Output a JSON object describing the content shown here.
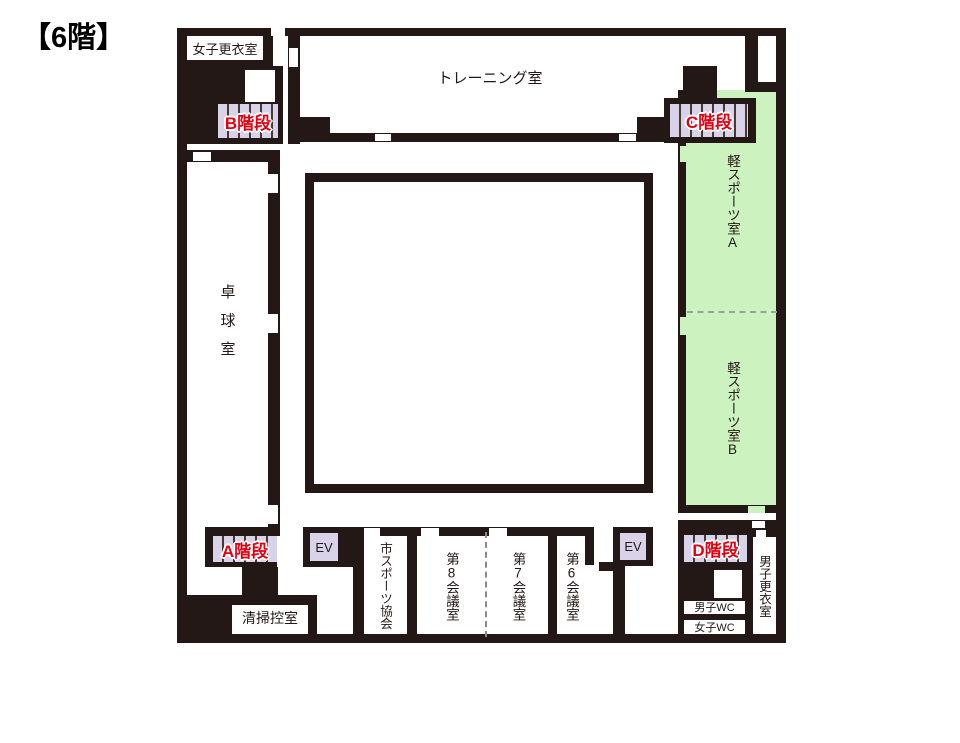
{
  "title": "【6階】",
  "colors": {
    "wall": "#231815",
    "stair_fill": "#d9d3ea",
    "green_room": "#ccf3bf",
    "stair_text_red": "#e60012",
    "background": "#ffffff"
  },
  "rooms": {
    "women_changing": "女子更衣室",
    "women_wc_top": "女子WC",
    "men_wc_top": "男子WC",
    "training": "トレーニング室",
    "table_tennis": "卓球室",
    "light_sports_a": "軽スポーツ室A",
    "light_sports_b": "軽スポーツ室B",
    "cleaning": "清掃控室",
    "sports_assoc": "市スポーツ協会",
    "meeting8": "第8会議室",
    "meeting7": "第7会議室",
    "meeting6": "第6会議室",
    "men_changing": "男子更衣室",
    "men_wc_bottom": "男子WC",
    "women_wc_bottom": "女子WC"
  },
  "stairs": {
    "a": "A階段",
    "b": "B階段",
    "c": "C階段",
    "d": "D階段"
  },
  "elevator": {
    "label": "EV"
  }
}
